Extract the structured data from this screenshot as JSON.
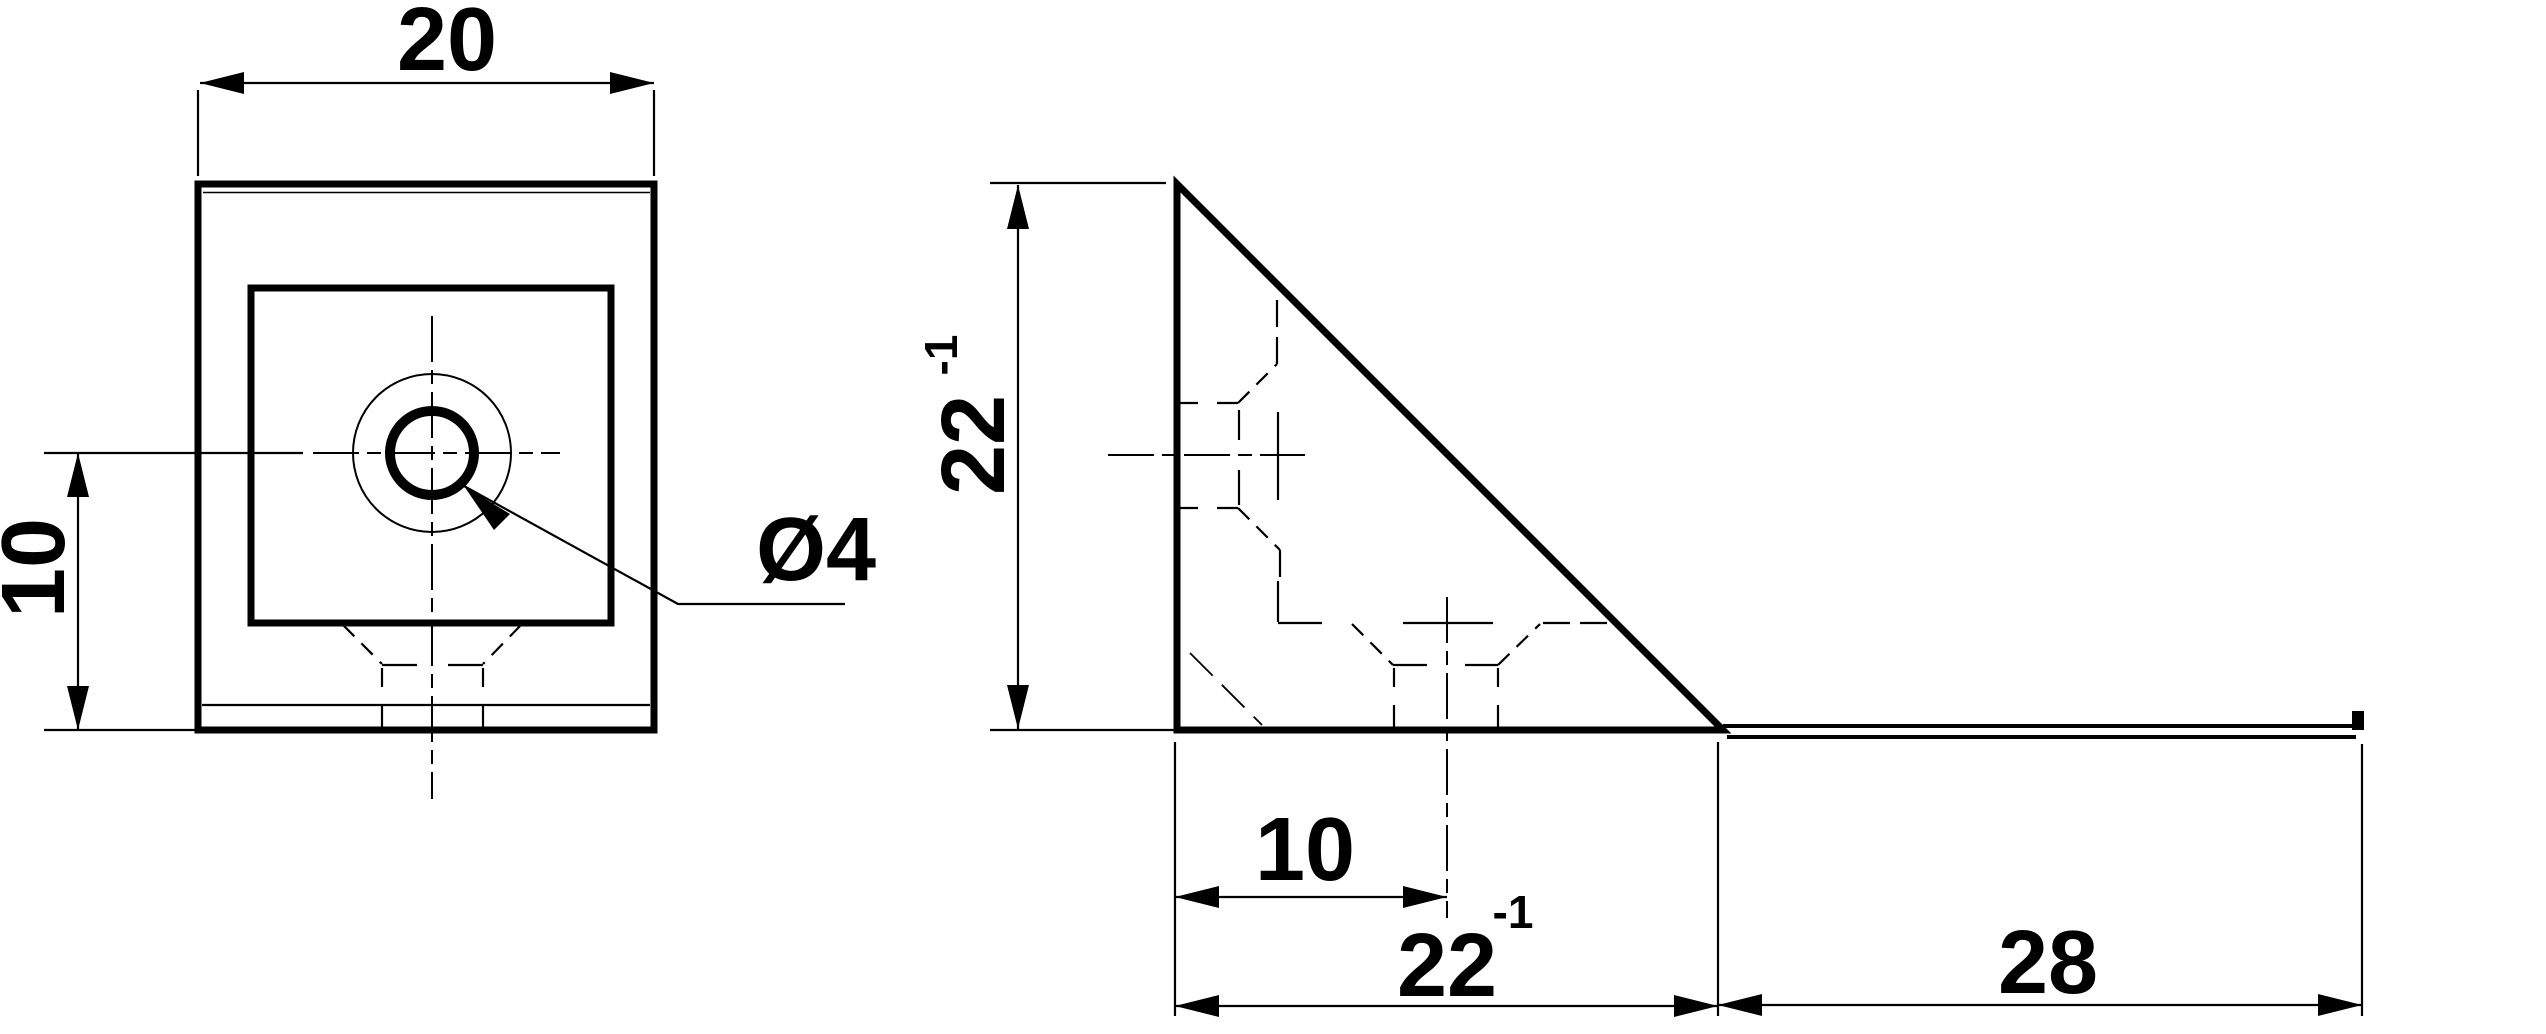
{
  "drawing": {
    "background_color": "#ffffff",
    "line_color": "#000000",
    "views": {
      "front": {
        "label": "front-view-of-corner-bracket",
        "dims": {
          "width": "20",
          "hole_offset": "10",
          "hole_diameter": "Ø4"
        }
      },
      "side": {
        "label": "side-view-of-corner-bracket",
        "dims": {
          "height": "22",
          "height_sup": "-1",
          "hole_offset": "10",
          "base": "22",
          "base_sup": "-1",
          "extension": "28"
        }
      }
    }
  }
}
